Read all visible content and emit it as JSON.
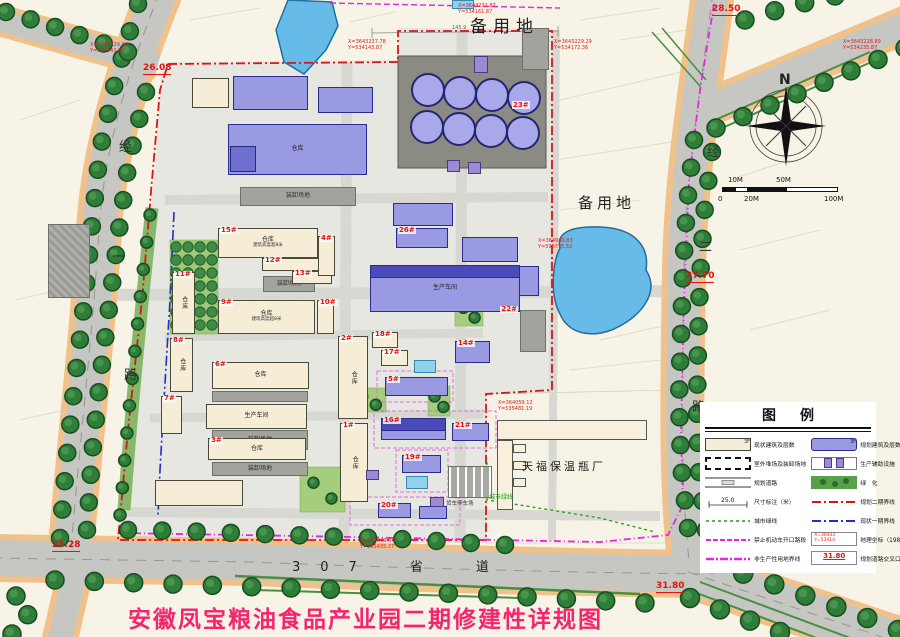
{
  "title": {
    "text": "安徽凤宝粮油食品产业园二期修建性详规图",
    "color": "#f4256e"
  },
  "colors": {
    "tree": "#2e7d39",
    "tree_dark": "#174d20",
    "tree_light": "#55a055",
    "road": "#c6c6c2",
    "curb": "#f0c18a",
    "water": "#66bbe8",
    "planned": "#9a9ae2",
    "existing": "#f6edd6",
    "phase2_boundary": "#d81616",
    "phase1_boundary": "#2030c0",
    "no_open_line": "#e326e3",
    "green_line": "#1aa01a",
    "accent_red": "#e31212",
    "title_pink": "#f4256e"
  },
  "roads": {
    "s307": "307　省　道",
    "jing_yi": [
      "经",
      "一",
      "路"
    ],
    "jing_er": [
      "经",
      "二",
      "路"
    ]
  },
  "area_labels": [
    {
      "x": 470,
      "y": 12,
      "text": "备用地",
      "size": 17,
      "ls": 6
    },
    {
      "x": 578,
      "y": 192,
      "text": "备用地",
      "size": 15,
      "ls": 4
    }
  ],
  "site_labels": [
    {
      "x": 522,
      "y": 458,
      "text": "天福保温瓶厂",
      "size": 11,
      "color": "#222",
      "ls": 3
    },
    {
      "x": 489,
      "y": 492,
      "text": "城市绿线",
      "size": 6,
      "color": "#1aa01a",
      "ls": 0
    },
    {
      "x": 446,
      "y": 499,
      "text": "货车停车场",
      "size": 5.5,
      "color": "#333",
      "ls": 0
    },
    {
      "x": 452,
      "y": 25,
      "text": "145.9",
      "size": 5,
      "color": "#666",
      "ls": 0
    }
  ],
  "compass": {
    "label": "N"
  },
  "scalebar": {
    "ticks": [
      "0",
      "10M",
      "20M",
      "50M",
      "100M"
    ]
  },
  "elevations": [
    {
      "x": 143,
      "y": 64,
      "v": "26.08"
    },
    {
      "x": 712,
      "y": 5,
      "v": "28.50"
    },
    {
      "x": 686,
      "y": 272,
      "v": "27.70"
    },
    {
      "x": 52,
      "y": 541,
      "v": "25.28"
    },
    {
      "x": 656,
      "y": 582,
      "v": "31.80"
    }
  ],
  "coords": [
    {
      "x": 90,
      "y": 42,
      "l1": "X=3643229.89",
      "l2": "Y=534143.87"
    },
    {
      "x": 348,
      "y": 39,
      "l1": "X=3643237.78",
      "l2": "Y=534143.87"
    },
    {
      "x": 458,
      "y": 3,
      "l1": "X=3643231.87",
      "l2": "Y=534161.87"
    },
    {
      "x": 554,
      "y": 39,
      "l1": "X=3643229.29",
      "l2": "Y=534172.36"
    },
    {
      "x": 843,
      "y": 39,
      "l1": "X=3643228.89",
      "l2": "Y=534235.87"
    },
    {
      "x": 538,
      "y": 238,
      "l1": "X=364960.83",
      "l2": "Y=598735.52"
    },
    {
      "x": 498,
      "y": 400,
      "l1": "X=364059.12",
      "l2": "Y=535481.19"
    },
    {
      "x": 360,
      "y": 538,
      "l1": "X=364019.64",
      "l2": "Y=535435.27"
    }
  ],
  "legend": {
    "title": "图例",
    "left": [
      {
        "key": "existing-building",
        "label": "现状建筑及层数",
        "badge": "3F"
      },
      {
        "key": "outdoor-yard",
        "label": "室外堆场及装卸场地"
      },
      {
        "key": "planned-road",
        "label": "规划道路"
      },
      {
        "key": "dimension",
        "label": "尺寸标注（米）",
        "badge": "25.0"
      },
      {
        "key": "city-green-line",
        "label": "城市绿线"
      },
      {
        "key": "no-vehicle-opening",
        "label": "禁止机动车开口路段"
      },
      {
        "key": "non-production-boundary",
        "label": "非生产性用地界线"
      }
    ],
    "right": [
      {
        "key": "planned-building",
        "label": "规划建筑及层数",
        "badge": "3F"
      },
      {
        "key": "aux-facility",
        "label": "生产辅助设施"
      },
      {
        "key": "greening",
        "label": "绿　化"
      },
      {
        "key": "phase2-boundary",
        "label": "规划二期界线"
      },
      {
        "key": "phase1-boundary",
        "label": "现状一期界线"
      },
      {
        "key": "geo-coordinate",
        "label": "地理坐标（1980西安坐标）",
        "badge": "X=36432|Y=53414"
      },
      {
        "key": "road-elevation",
        "label": "规划道路交叉口高程",
        "badge": "31.80"
      }
    ]
  },
  "buildings": [
    {
      "x": 48,
      "y": 224,
      "w": 42,
      "h": 74,
      "t": "yh"
    },
    {
      "x": 240,
      "y": 187,
      "w": 116,
      "h": 19,
      "t": "y",
      "l": "装卸场地"
    },
    {
      "x": 522,
      "y": 28,
      "w": 27,
      "h": 42,
      "t": "y"
    },
    {
      "x": 520,
      "y": 310,
      "w": 26,
      "h": 42,
      "t": "y"
    },
    {
      "x": 263,
      "y": 276,
      "w": 52,
      "h": 16,
      "t": "y",
      "l": "装卸场地"
    },
    {
      "x": 212,
      "y": 391,
      "w": 96,
      "h": 11,
      "t": "y"
    },
    {
      "x": 212,
      "y": 430,
      "w": 96,
      "h": 20,
      "t": "y",
      "l": "装卸场地"
    },
    {
      "x": 212,
      "y": 462,
      "w": 96,
      "h": 14,
      "t": "y",
      "l": "装卸场地"
    },
    {
      "x": 448,
      "y": 466,
      "w": 44,
      "h": 32,
      "t": "yp"
    },
    {
      "x": 452,
      "y": 0,
      "w": 22,
      "h": 9,
      "t": "pool"
    },
    {
      "x": 192,
      "y": 78,
      "w": 37,
      "h": 30,
      "t": "e"
    },
    {
      "x": 233,
      "y": 76,
      "w": 75,
      "h": 34,
      "t": "p"
    },
    {
      "x": 318,
      "y": 87,
      "w": 55,
      "h": 26,
      "t": "p"
    },
    {
      "x": 228,
      "y": 124,
      "w": 139,
      "h": 51,
      "t": "p",
      "l": "仓库"
    },
    {
      "x": 230,
      "y": 146,
      "w": 26,
      "h": 26,
      "t": "p2"
    },
    {
      "x": 393,
      "y": 203,
      "w": 60,
      "h": 23,
      "t": "p"
    },
    {
      "x": 396,
      "y": 228,
      "w": 52,
      "h": 20,
      "t": "p",
      "n": "26#"
    },
    {
      "x": 462,
      "y": 237,
      "w": 56,
      "h": 25,
      "t": "p"
    },
    {
      "x": 489,
      "y": 266,
      "w": 50,
      "h": 30,
      "t": "p"
    },
    {
      "x": 370,
      "y": 265,
      "w": 150,
      "h": 47,
      "t": "p",
      "n": "22#",
      "np": "br",
      "l": "生产车间",
      "band": 1
    },
    {
      "x": 218,
      "y": 228,
      "w": 100,
      "h": 30,
      "t": "e",
      "n": "15#",
      "l": "仓库",
      "s": "建筑高度超8米"
    },
    {
      "x": 262,
      "y": 258,
      "w": 58,
      "h": 13,
      "t": "e",
      "n": "12#"
    },
    {
      "x": 292,
      "y": 271,
      "w": 40,
      "h": 13,
      "t": "e",
      "n": "13#"
    },
    {
      "x": 318,
      "y": 236,
      "w": 17,
      "h": 40,
      "t": "e",
      "n": "4#",
      "v": 1
    },
    {
      "x": 218,
      "y": 300,
      "w": 97,
      "h": 34,
      "t": "e",
      "n": "9#",
      "l": "仓库",
      "s": "建筑高度超8米"
    },
    {
      "x": 317,
      "y": 300,
      "w": 17,
      "h": 34,
      "t": "e",
      "n": "10#",
      "v": 1
    },
    {
      "x": 172,
      "y": 272,
      "w": 23,
      "h": 62,
      "t": "e",
      "n": "11#",
      "l": "仓库",
      "v": 1
    },
    {
      "x": 170,
      "y": 338,
      "w": 23,
      "h": 54,
      "t": "e",
      "n": "8#",
      "l": "仓库",
      "v": 1
    },
    {
      "x": 161,
      "y": 396,
      "w": 21,
      "h": 38,
      "t": "e",
      "n": "7#",
      "v": 1
    },
    {
      "x": 212,
      "y": 362,
      "w": 97,
      "h": 27,
      "t": "e",
      "n": "6#",
      "l": "仓库"
    },
    {
      "x": 206,
      "y": 404,
      "w": 101,
      "h": 25,
      "t": "e",
      "l": "生产车间"
    },
    {
      "x": 208,
      "y": 438,
      "w": 98,
      "h": 22,
      "t": "e",
      "n": "3#",
      "l": "仓库"
    },
    {
      "x": 155,
      "y": 480,
      "w": 88,
      "h": 26,
      "t": "e"
    },
    {
      "x": 338,
      "y": 336,
      "w": 30,
      "h": 83,
      "t": "e",
      "n": "2#",
      "l": "仓库",
      "v": 1
    },
    {
      "x": 340,
      "y": 423,
      "w": 28,
      "h": 79,
      "t": "e",
      "n": "1#",
      "l": "仓库",
      "v": 1
    },
    {
      "x": 372,
      "y": 332,
      "w": 26,
      "h": 16,
      "t": "e",
      "n": "18#"
    },
    {
      "x": 381,
      "y": 350,
      "w": 27,
      "h": 16,
      "t": "e",
      "n": "17#"
    },
    {
      "x": 414,
      "y": 360,
      "w": 22,
      "h": 13,
      "t": "pool"
    },
    {
      "x": 455,
      "y": 341,
      "w": 35,
      "h": 22,
      "t": "p",
      "n": "14#"
    },
    {
      "x": 385,
      "y": 377,
      "w": 63,
      "h": 19,
      "t": "p",
      "n": "5#"
    },
    {
      "x": 381,
      "y": 418,
      "w": 65,
      "h": 22,
      "t": "p",
      "n": "16#",
      "band": 1
    },
    {
      "x": 452,
      "y": 423,
      "w": 37,
      "h": 18,
      "t": "p",
      "n": "21#"
    },
    {
      "x": 402,
      "y": 455,
      "w": 39,
      "h": 18,
      "t": "p",
      "n": "19#"
    },
    {
      "x": 406,
      "y": 476,
      "w": 22,
      "h": 13,
      "t": "pool"
    },
    {
      "x": 378,
      "y": 503,
      "w": 33,
      "h": 15,
      "t": "p",
      "n": "20#"
    },
    {
      "x": 419,
      "y": 506,
      "w": 28,
      "h": 13,
      "t": "p"
    },
    {
      "x": 366,
      "y": 470,
      "w": 13,
      "h": 10,
      "t": "a"
    },
    {
      "x": 430,
      "y": 497,
      "w": 14,
      "h": 10,
      "t": "a"
    },
    {
      "x": 474,
      "y": 56,
      "w": 14,
      "h": 17,
      "t": "a"
    },
    {
      "x": 447,
      "y": 160,
      "w": 13,
      "h": 12,
      "t": "a"
    },
    {
      "x": 468,
      "y": 162,
      "w": 13,
      "h": 12,
      "t": "a"
    },
    {
      "x": 497,
      "y": 420,
      "w": 150,
      "h": 20,
      "t": "e2"
    },
    {
      "x": 497,
      "y": 440,
      "w": 16,
      "h": 70,
      "t": "e2"
    },
    {
      "x": 513,
      "y": 444,
      "w": 13,
      "h": 9,
      "t": "e2"
    },
    {
      "x": 513,
      "y": 461,
      "w": 13,
      "h": 9,
      "t": "e2"
    },
    {
      "x": 513,
      "y": 478,
      "w": 13,
      "h": 9,
      "t": "e2"
    }
  ],
  "tanks": {
    "pad": [
      398,
      56,
      148,
      112
    ],
    "r": 17,
    "num": "23#",
    "numx": 512,
    "numy": 101,
    "centers": [
      [
        428,
        90
      ],
      [
        460,
        93
      ],
      [
        492,
        95
      ],
      [
        524,
        98
      ],
      [
        427,
        127
      ],
      [
        459,
        129
      ],
      [
        491,
        131
      ],
      [
        523,
        133
      ]
    ]
  },
  "greens": {
    "orchard": [
      170,
      240,
      48,
      94
    ],
    "lawns": [
      [
        352,
        388,
        34,
        24
      ],
      [
        300,
        467,
        45,
        45
      ],
      [
        428,
        386,
        22,
        30
      ],
      [
        455,
        298,
        28,
        28
      ]
    ]
  }
}
